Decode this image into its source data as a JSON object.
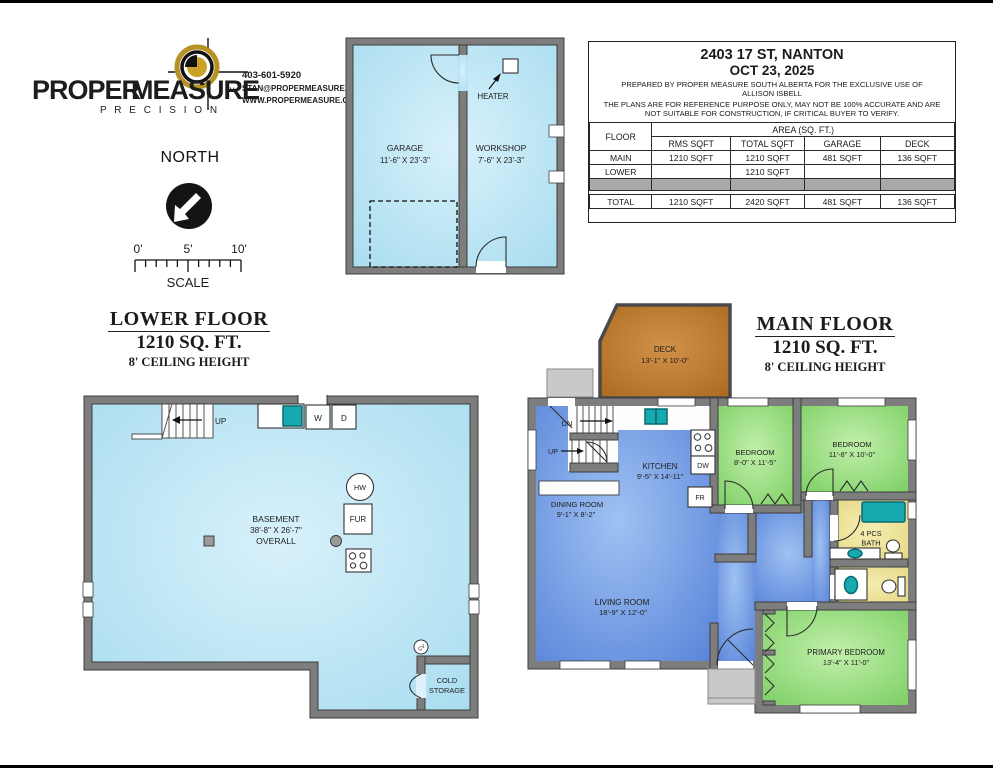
{
  "colors": {
    "wall_gray": "#7d7d7d",
    "wall_outline": "#3d3d3d",
    "basement_floor_edge": "#a9ddef",
    "basement_floor_center": "#d8f1fb",
    "living_blue_edge": "#5580d8",
    "living_blue_center": "#9fc2f2",
    "bedroom_green_edge": "#78cc60",
    "bedroom_green_center": "#c2f0ab",
    "bath_yellow_edge": "#e3d580",
    "bath_yellow_center": "#f5eeb2",
    "deck_brown_edge": "#a96a1e",
    "deck_brown_center": "#d2914a",
    "fixture_teal": "#17a9b0",
    "concrete_gray": "#c9c9c9",
    "brand_gold": "#b49324",
    "table_gray_row": "#a9a9a9"
  },
  "logo": {
    "brand_black": "PROPER",
    "brand_gold": "MEASURE",
    "tm": "TM",
    "tagline": "P R E C I S I O N",
    "phone": "403-601-5920",
    "email": "STAN@PROPERMEASURE.COM",
    "website": "WWW.PROPERMEASURE.COM"
  },
  "compass": {
    "label": "NORTH"
  },
  "scale_bar": {
    "ticks": [
      "0'",
      "5'",
      "10'"
    ],
    "label": "SCALE"
  },
  "info_panel": {
    "address": "2403 17 ST, NANTON",
    "date": "OCT 23, 2025",
    "prepared_line1": "PREPARED BY PROPER MEASURE SOUTH ALBERTA FOR THE EXCLUSIVE USE OF",
    "prepared_line2": "ALLISON ISBELL",
    "disclaimer_line1": "THE PLANS ARE FOR REFERENCE PURPOSE ONLY, MAY NOT BE 100% ACCURATE AND ARE",
    "disclaimer_line2": "NOT SUITABLE FOR CONSTRUCTION, IF CRITICAL BUYER TO VERIFY.",
    "table": {
      "floor_header": "FLOOR",
      "area_header": "AREA (SQ. FT.)",
      "col1": "RMS SQFT",
      "col2": "TOTAL SQFT",
      "col3": "GARAGE",
      "col4": "DECK",
      "rows": [
        {
          "floor": "MAIN",
          "rms": "1210 SQFT",
          "total": "1210 SQFT",
          "garage": "481 SQFT",
          "deck": "136 SQFT"
        },
        {
          "floor": "LOWER",
          "rms": "",
          "total": "1210 SQFT",
          "garage": "",
          "deck": ""
        },
        {
          "floor": "TOTAL",
          "rms": "1210 SQFT",
          "total": "2420 SQFT",
          "garage": "481 SQFT",
          "deck": "136 SQFT"
        }
      ]
    }
  },
  "garage_plan": {
    "garage_name": "GARAGE",
    "garage_dims": "11'-6\" X 23'-3\"",
    "workshop_name": "WORKSHOP",
    "workshop_dims": "7'-6\" X 23'-3\"",
    "heater_label": "HEATER"
  },
  "lower_floor": {
    "title": "LOWER FLOOR",
    "area": "1210 SQ. FT.",
    "ceiling": "8' CEILING HEIGHT",
    "room": "BASEMENT",
    "dims": "38'-8\" X 26'-7\"",
    "overall": "OVERALL",
    "up_label": "UP",
    "washer": "W",
    "dryer": "D",
    "hot_water": "HW",
    "furnace": "FUR",
    "cv_label": "CV",
    "cold_storage_line1": "COLD",
    "cold_storage_line2": "STORAGE"
  },
  "main_floor": {
    "title": "MAIN FLOOR",
    "area": "1210 SQ. FT.",
    "ceiling": "8' CEILING HEIGHT",
    "deck_name": "DECK",
    "deck_dims": "13'-1\" X 10'-0\"",
    "dn_label": "DN",
    "up_label": "UP",
    "kitchen_name": "KITCHEN",
    "kitchen_dims": "9'-5\" X 14'-11\"",
    "dw_label": "DW",
    "fr_label": "FR",
    "dining_name": "DINING ROOM",
    "dining_dims": "9'-1\" X 8'-2\"",
    "living_name": "LIVING ROOM",
    "living_dims": "18'-9\" X 12'-0\"",
    "bedroom1_name": "BEDROOM",
    "bedroom1_dims": "8'-0\" X 11'-5\"",
    "bedroom2_name": "BEDROOM",
    "bedroom2_dims": "11'-8\" X 10'-0\"",
    "bath_line1": "4 PCS",
    "bath_line2": "BATH",
    "primary_name": "PRIMARY BEDROOM",
    "primary_dims": "13'-4\" X 11'-0\""
  }
}
